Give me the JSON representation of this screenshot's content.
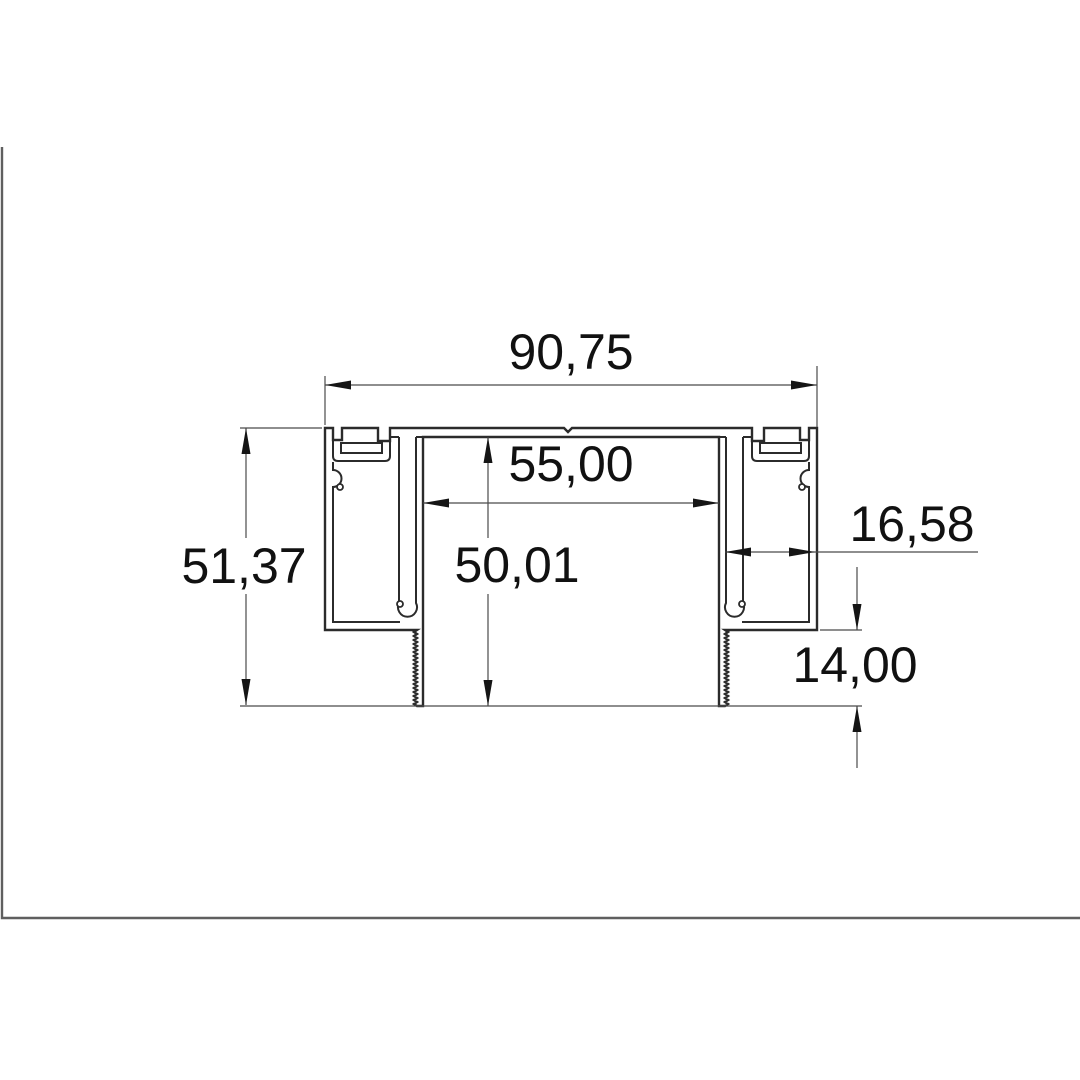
{
  "drawing": {
    "kind": "profile-cross-section-line-drawing",
    "decimal_separator": ",",
    "dimensions": {
      "overall_width": "90,75",
      "channel_width": "55,00",
      "channel_depth": "50,01",
      "overall_height": "51,37",
      "side_pocket_width": "16,58",
      "leg_height": "14,00"
    },
    "colors": {
      "background": "#ffffff",
      "profile_line": "#2b2b2b",
      "dimension_line": "#4b4b4b",
      "arrow": "#151515",
      "text": "#111111",
      "frame_line": "#5f5f5f"
    }
  }
}
